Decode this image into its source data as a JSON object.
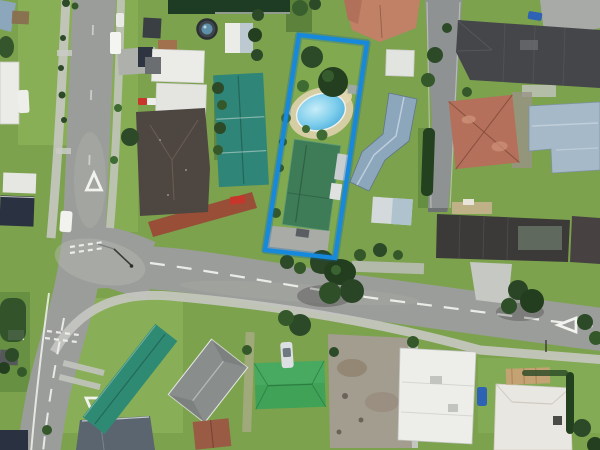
{
  "scene": {
    "kind": "aerial-photograph",
    "highlight": "blue boundary outline around residential parcel with swimming pool"
  },
  "colors": {
    "grass": "#7CA24D",
    "grass_light": "#96BC63",
    "grass_dark": "#4E7A35",
    "road_asphalt": "#9B9D9A",
    "road_worn": "#B6B8B3",
    "side_street": "#8F9293",
    "footpath": "#C6C8C2",
    "concrete": "#C6C8C3",
    "road_marking": "#F2F3EF",
    "boundary_blue": "#1789DC",
    "boundary_glow": "#0A65AD",
    "pool_water": "#7DCDEC",
    "pool_deck": "#D9CFA8",
    "parcel_roof_green": "#3E7B57",
    "teal_roof": "#2F8577",
    "teal_roof_south": "#2F8A74",
    "bright_green_roof": "#3FA257",
    "dark_green_roof": "#1E3B24",
    "blue_gray_roof": "#8CA6BC",
    "light_blue_roof": "#A6B9C8",
    "white_roof": "#EBEBE7",
    "gray_roof": "#898D8B",
    "charcoal_roof": "#45464A",
    "dark_roof": "#3C3A39",
    "slate_roof": "#5A6570",
    "navy_roof": "#2A3140",
    "brown_hip_roof": "#4E4640",
    "terracotta_roof": "#B4705A",
    "salmon_roof": "#C08167",
    "brown_shed_roof": "#9A5B45",
    "tan_deck": "#C5B28E",
    "gravel": "#A39D8F",
    "red_paving": "#9E4034",
    "tree_dark": "#2C4A28",
    "tree_mid": "#3E6B33",
    "car_red": "#C8352B",
    "car_blue": "#2E62B5",
    "car_white": "#EEEFEA"
  }
}
